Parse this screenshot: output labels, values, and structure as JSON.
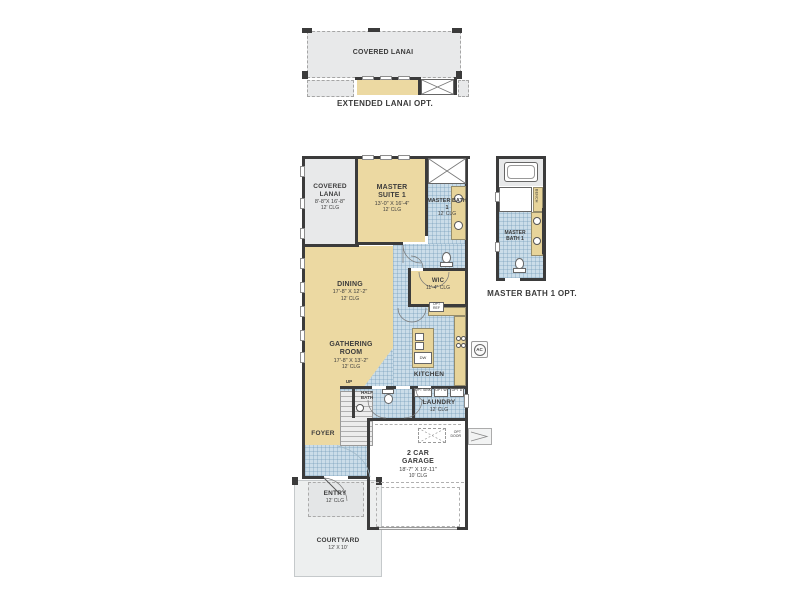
{
  "extended_lanai_plan": {
    "covered_lanai_label": "COVERED LANAI",
    "caption": "EXTENDED LANAI OPT."
  },
  "main_plan": {
    "covered_lanai": {
      "name": "COVERED LANAI",
      "dims": "8'-8\"X 16'-8\"",
      "clg": "12' CLG"
    },
    "master_suite": {
      "name": "MASTER SUITE 1",
      "dims": "13'-0\" X 16'-4\"",
      "clg": "12' CLG"
    },
    "master_bath": {
      "name": "MASTER BATH 1",
      "clg": "12' CLG"
    },
    "wic": {
      "name": "WIC",
      "clg": "11'-4\" CLG"
    },
    "dining": {
      "name": "DINING",
      "dims": "17'-8\" X 12'-2\"",
      "clg": "12' CLG"
    },
    "gathering_room": {
      "name": "GATHERING ROOM",
      "dims": "17'-8\" X 13'-2\"",
      "clg": "12' CLG"
    },
    "kitchen": {
      "name": "KITCHEN"
    },
    "half_bath": {
      "name": "HALF BATH"
    },
    "laundry": {
      "name": "LAUNDRY",
      "clg": "12' CLG"
    },
    "foyer": {
      "name": "FOYER"
    },
    "garage": {
      "name": "2 CAR GARAGE",
      "dims": "18'-7\" X 19'-11\"",
      "clg": "10' CLG"
    },
    "entry": {
      "name": "ENTRY",
      "clg": "12' CLG"
    },
    "courtyard": {
      "name": "COURTYARD",
      "dims": "12' X 10'"
    },
    "stairs_up": "UP"
  },
  "master_bath_opt_plan": {
    "room": "MASTER BATH 1",
    "bench": "BENCH",
    "caption": "MASTER BATH 1 OPT."
  },
  "annotations": {
    "ac": "AC",
    "dw": "DW",
    "opt_ref": "OPT REF",
    "opt_door": "OPT DOOR",
    "opt_sink": "OPT SINK",
    "opt_washer": "OPT W",
    "opt_dryer": "OPT D"
  },
  "colors": {
    "wall": "#3b3b3b",
    "room_tan": "#ecd9a2",
    "room_gray": "#e8e9ea",
    "tile_blue": "#cbdde9",
    "text": "#3c3c3c"
  }
}
